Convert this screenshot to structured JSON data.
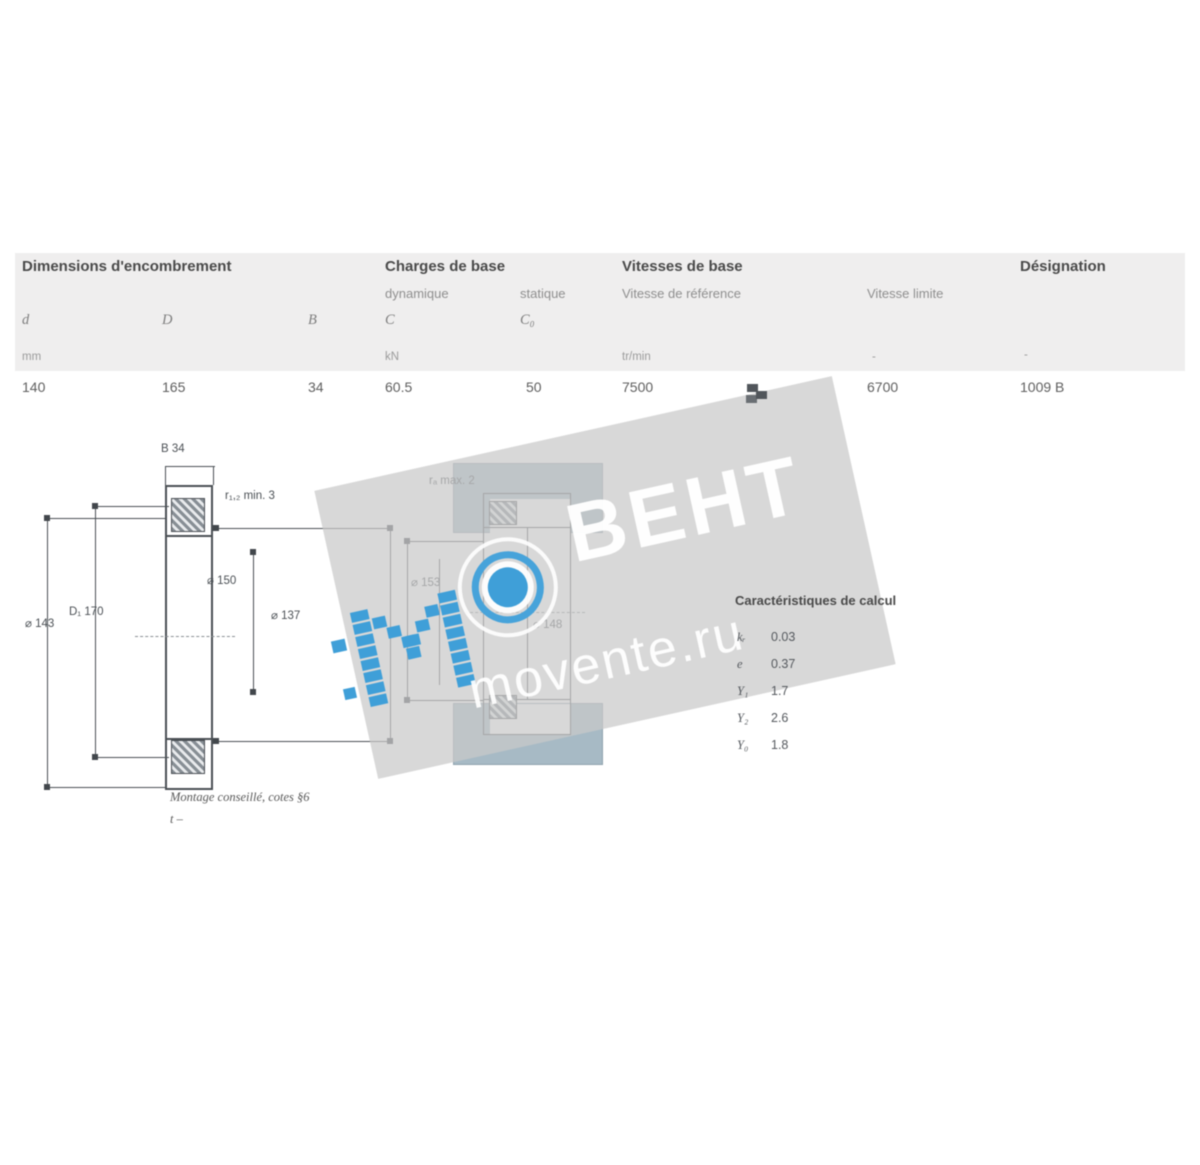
{
  "colors": {
    "watermark_blue": "#3f9fd8",
    "band_gray": "#c9c9c9",
    "housing_blue_gray": "#a7bac5",
    "header_band": "#efeeee"
  },
  "table": {
    "group_headers": {
      "dimensions": "Dimensions d'encombrement",
      "loads": "Charges de base",
      "speeds": "Vitesses de base",
      "designation": "Désignation"
    },
    "subheaders": {
      "dynamic": "dynamique",
      "static": "statique",
      "ref_speed": "Vitesse de référence",
      "limit_speed": "Vitesse limite"
    },
    "symbols": {
      "d": "d",
      "D": "D",
      "B": "B",
      "C": "C",
      "C0": "C₀"
    },
    "units": {
      "dimensions": "mm",
      "loads": "kN",
      "speeds": "tr/min",
      "limit_dash": "-",
      "designation_dash": "-"
    },
    "row": {
      "d": "140",
      "D": "165",
      "B": "34",
      "C": "60.5",
      "C0": "50",
      "ref_speed": "7500",
      "limit_speed": "6700",
      "designation": "1009 B"
    }
  },
  "drawings": {
    "left": {
      "dim_width": "B  34",
      "dim_fillet": "r₁,₂ min.  3",
      "dim_outer": "⌀ 143",
      "dim_D1": "D₁  170",
      "dim_inner1": "⌀ 150",
      "dim_inner2": "⌀ 137",
      "caption": "Montage conseillé, cotes §6",
      "caption2": "t   –"
    },
    "right": {
      "dim_fillet": "rₐ max.  2",
      "dim_Da": "⌀ 153",
      "dim_da": "⌀ 148"
    }
  },
  "calc": {
    "title": "Caractéristiques de calcul",
    "rows": [
      {
        "k": "kᵣ",
        "v": "0.03"
      },
      {
        "k": "e",
        "v": "0.37"
      },
      {
        "k": "Y₁",
        "v": "1.7"
      },
      {
        "k": "Y₂",
        "v": "2.6"
      },
      {
        "k": "Y₀",
        "v": "1.8"
      }
    ]
  },
  "watermark": {
    "m": "М",
    "brand": "ВЕНТ",
    "site": "movente.ru"
  }
}
